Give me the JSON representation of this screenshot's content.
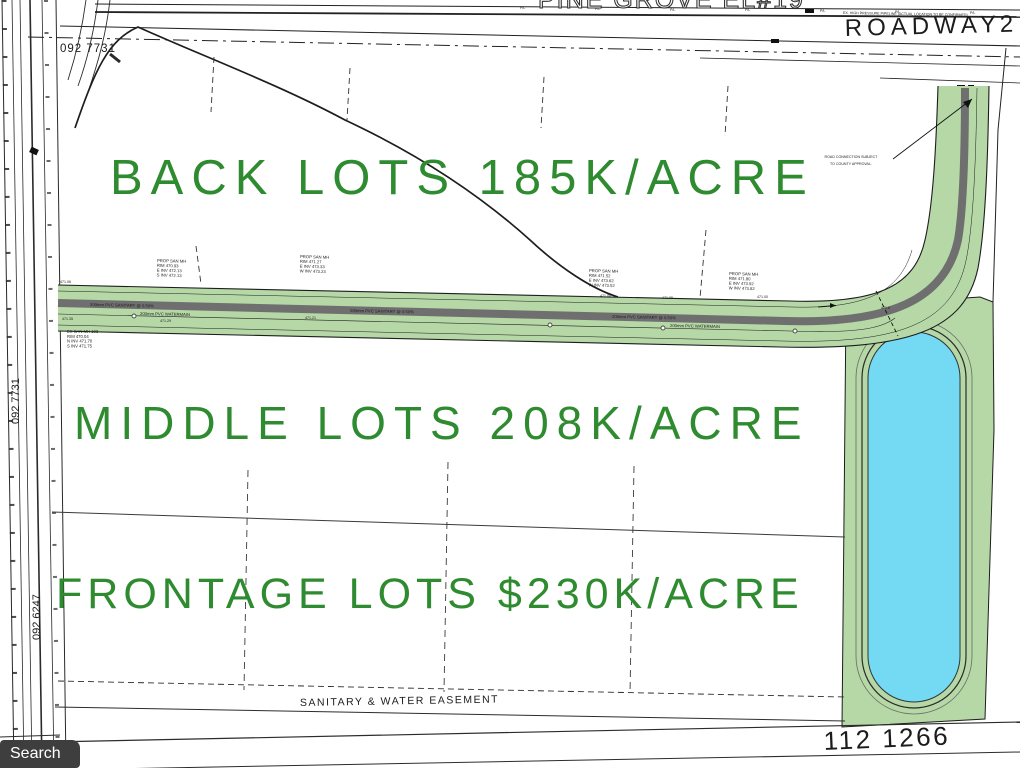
{
  "colors": {
    "corridor_green": "#b5d8a6",
    "pavement_gray": "#6f6f6f",
    "pond_blue": "#74d9f2",
    "label_green": "#2f8b30",
    "search_badge_bg": "#3e3e3e"
  },
  "annotations": {
    "back_lots": "BACK LOTS 185K/ACRE",
    "middle_lots": "MIDDLE LOTS 208K/ACRE",
    "frontage_lots": "FRONTAGE LOTS $230K/ACRE"
  },
  "top": {
    "clipped_title": "PINE GROVE EL#19",
    "roadway_label": "ROADWAY",
    "roadway_number": "2",
    "pl_marker": "P/L",
    "pipeline_note": "EX. HIGH PRESSURE PIPELINE (ACTUAL LOCATION TO BE CONFIRMED)",
    "parcel_number": "092 7731"
  },
  "left_edge": {
    "parcel_label_1": "092 7731",
    "parcel_label_2": "092 6247"
  },
  "road_note": {
    "line1": "ROAD CONNECTION SUBJECT",
    "line2": "TO COUNTY APPROVAL."
  },
  "road": {
    "sanitary_label": "200mm PVC SANITARY @ 0.50%",
    "watermain_label": "200mm PVC WATERMAIN",
    "pond_elevation": "471.8",
    "elevations": [
      "471.06",
      "471.35",
      "471.29",
      "471.21",
      "471.08",
      "471.05",
      "471.00"
    ],
    "manholes": [
      {
        "l1": "PROP SAN MH",
        "l2": "RIM 470.93",
        "l3": "E INV 472.13",
        "l4": "S INV 472.13"
      },
      {
        "l1": "PROP SAN MH",
        "l2": "RIM 471.27",
        "l3": "E INV 473.33",
        "l4": "W INV 473.23"
      },
      {
        "l1": "PROP SAN MH",
        "l2": "RIM 471.52",
        "l3": "E INV 473.62",
        "l4": "W INV 473.52"
      },
      {
        "l1": "PROP SAN MH",
        "l2": "RIM 471.80",
        "l3": "E INV 473.92",
        "l4": "W INV 473.82"
      }
    ],
    "ex_manhole": {
      "l1": "EX SAN MH 103",
      "l2": "RIM 470.04",
      "l3": "N INV 471.70",
      "l4": "S INV 471.75"
    }
  },
  "bottom": {
    "easement_label": "SANITARY & WATER EASEMENT",
    "parcel_number": "112 1266"
  },
  "search_button": "Search"
}
